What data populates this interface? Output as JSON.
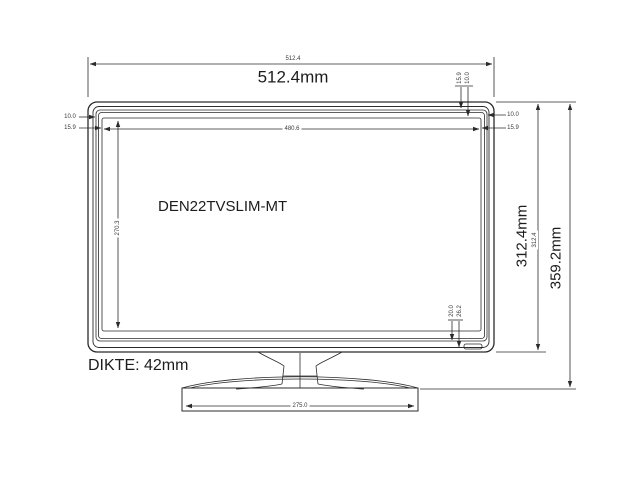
{
  "model": "DEN22TVSLIM-MT",
  "thickness": "DIKTE: 42mm",
  "dims": {
    "overall_width": "512.4mm",
    "overall_width_ref": "512.4",
    "screen_width_ref": "480.6",
    "screen_height_ref": "270.3",
    "screen_part_height": "312.4mm",
    "screen_part_height_ref": "312.4",
    "total_height": "359.2mm",
    "base_width_ref": "275.0",
    "bezel_left_a": "10.0",
    "bezel_left_b": "15.9",
    "bezel_right_a": "10.0",
    "bezel_right_b": "15.9",
    "bezel_top_a": "15.9",
    "bezel_top_b": "10.0",
    "bottom_detail_a": "20.0",
    "bottom_detail_b": "26.2"
  }
}
